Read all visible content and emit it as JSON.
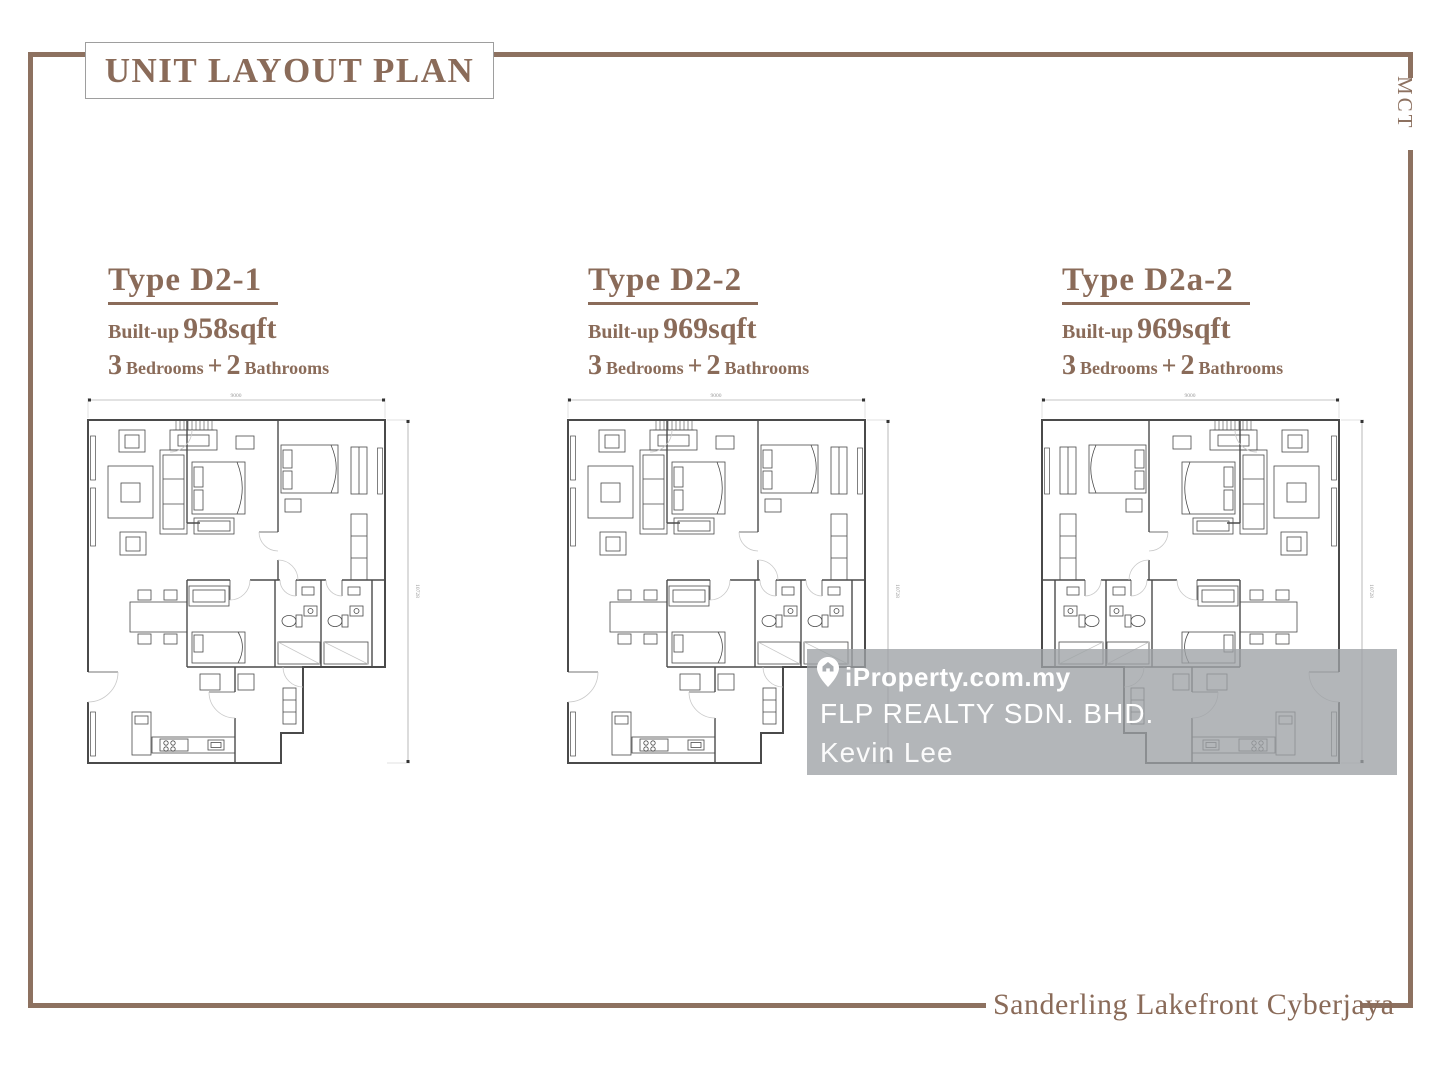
{
  "page": {
    "title": "UNIT LAYOUT PLAN",
    "side_brand": "MCT",
    "footer_project": "Sanderling Lakefront Cyberjaya",
    "accent_color": "#8d7160"
  },
  "units": [
    {
      "type": "Type D2-1",
      "built_up_label": "Built-up",
      "built_up_value": "958sqft",
      "bed_count": "3",
      "bed_label": "Bedrooms",
      "plus_sign": "+",
      "bath_count": "2",
      "bath_label": "Bathrooms",
      "dim_top": "9000",
      "dim_side": "10728"
    },
    {
      "type": "Type D2-2",
      "built_up_label": "Built-up",
      "built_up_value": "969sqft",
      "bed_count": "3",
      "bed_label": "Bedrooms",
      "plus_sign": "+",
      "bath_count": "2",
      "bath_label": "Bathrooms",
      "dim_top": "9000",
      "dim_side": "10728"
    },
    {
      "type": "Type D2a-2",
      "built_up_label": "Built-up",
      "built_up_value": "969sqft",
      "bed_count": "3",
      "bed_label": "Bedrooms",
      "plus_sign": "+",
      "bath_count": "2",
      "bath_label": "Bathrooms",
      "dim_top": "9000",
      "dim_side": "10728"
    }
  ],
  "watermark": {
    "portal": "iProperty.com.my",
    "agency": "FLP REALTY SDN. BHD.",
    "agent": "Kevin Lee"
  }
}
